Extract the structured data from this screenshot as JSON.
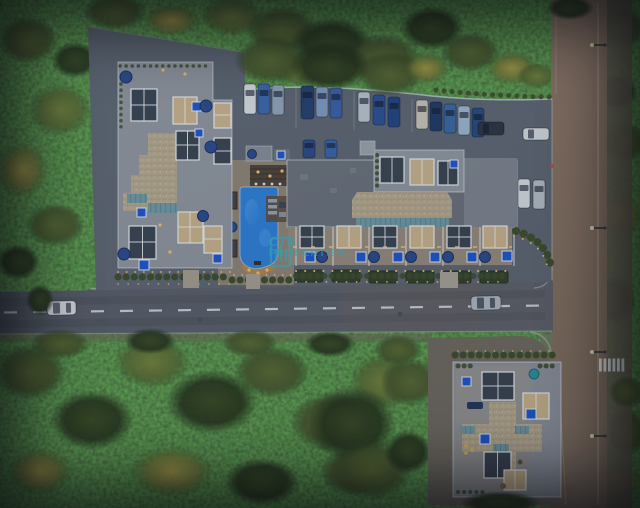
{
  "watermark": {
    "line1": "CIG",
    "line2": "PROPERTIES",
    "logo": "building-logo",
    "color": "#3ab0bf"
  },
  "palette": {
    "forest_dark": "#1d2a15",
    "forest_mid": "#55652f",
    "forest_light": "#6b7838",
    "forest_yellow": "#a59b45",
    "asphalt": "#5d6570",
    "road_horizontal": "#575d66",
    "road_vertical": "#86715f",
    "sidewalk": "#6b6254",
    "roof_light_gray": "#8e949c",
    "roof_dark_gray": "#697079",
    "gravel_tan": "#b5a88e",
    "gable_teal": "#6f98a2",
    "pool_blue": "#2e7ed6",
    "hot_tub_blue": "#1d55cc",
    "umbrella_navy": "#2a4a8c",
    "light_warm": "#f0bf68",
    "curb_light": "#b9c2c4",
    "lane_marking": "#e9eef0"
  },
  "scene_features": {
    "buildings": [
      "west-apartment-building",
      "main-apartment-building",
      "southeast-building"
    ],
    "amenities": [
      "swimming-pool",
      "pool-deck",
      "rooftop-pergolas",
      "hot-tubs",
      "landscaped-gardens"
    ],
    "roads": [
      "main-road-horizontal",
      "side-road-vertical",
      "crosswalk",
      "surface-parking"
    ],
    "vehicles": {
      "parked_count": 20,
      "on_road_count": 2
    }
  }
}
